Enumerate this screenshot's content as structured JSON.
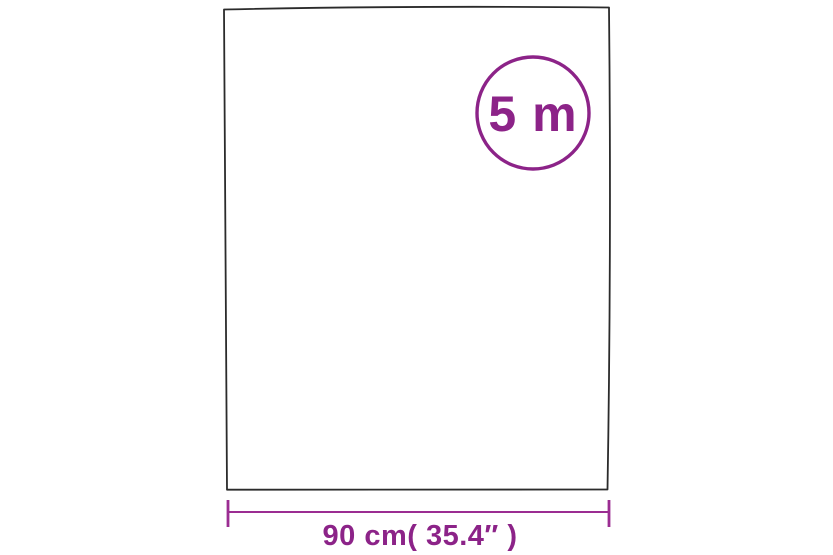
{
  "badge": {
    "label": "5 m"
  },
  "dimension": {
    "label": "90 cm( 35.4″ )"
  },
  "colors": {
    "accent": "#8C2388",
    "dimension_line": "#9B2D92",
    "outline": "#2b2b2b",
    "background": "#ffffff"
  }
}
